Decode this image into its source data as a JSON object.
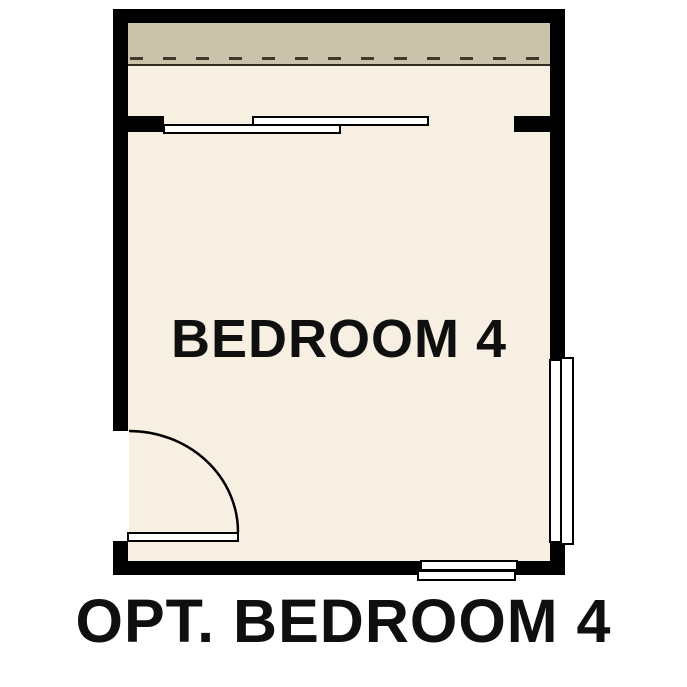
{
  "floorplan": {
    "room_label": "BEDROOM 4",
    "caption": "OPT. BEDROOM 4",
    "colors": {
      "wall": "#000000",
      "floor": "#f6efe2",
      "overhang": "#cbc2ab",
      "dash": "#3e3a2e",
      "line": "#2f2c24",
      "text": "#0f0f0f",
      "background": "#ffffff"
    },
    "features": [
      "roof-overhang-dashed-line",
      "sliding-window-top",
      "door-swing-bottom-left",
      "window-right-wall",
      "window-bottom-wall"
    ]
  }
}
